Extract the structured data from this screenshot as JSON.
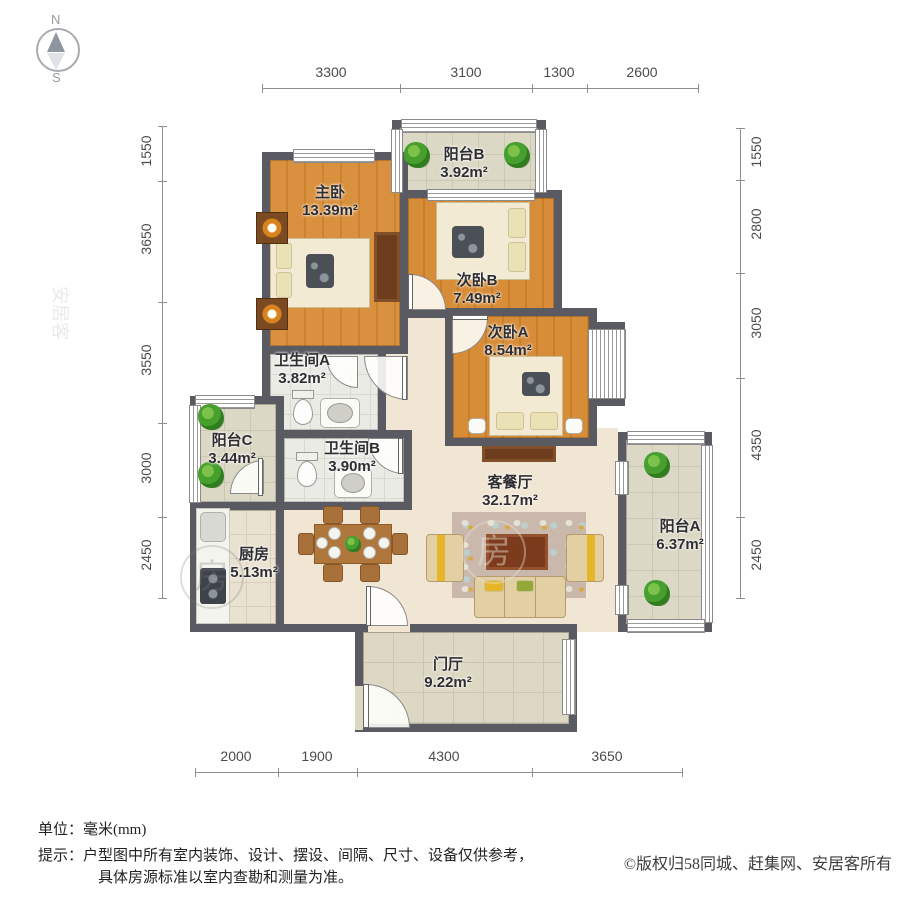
{
  "compass": {
    "north": "N",
    "south": "S"
  },
  "dims": {
    "top": [
      "3300",
      "3100",
      "1300",
      "2600"
    ],
    "bottom": [
      "2000",
      "1900",
      "4300",
      "3650"
    ],
    "left": [
      "1550",
      "3650",
      "3550",
      "3000",
      "2450"
    ],
    "right": [
      "1550",
      "2800",
      "3050",
      "4350",
      "2450"
    ]
  },
  "rooms": {
    "master": {
      "name": "主卧",
      "area": "13.39m²"
    },
    "balcony_b": {
      "name": "阳台B",
      "area": "3.92m²"
    },
    "bedroom_b": {
      "name": "次卧B",
      "area": "7.49m²"
    },
    "bedroom_a": {
      "name": "次卧A",
      "area": "8.54m²"
    },
    "bath_a": {
      "name": "卫生间A",
      "area": "3.82m²"
    },
    "balcony_c": {
      "name": "阳台C",
      "area": "3.44m²"
    },
    "bath_b": {
      "name": "卫生间B",
      "area": "3.90m²"
    },
    "kitchen": {
      "name": "厨房",
      "area": "5.13m²"
    },
    "living": {
      "name": "客餐厅",
      "area": "32.17m²"
    },
    "balcony_a": {
      "name": "阳台A",
      "area": "6.37m²"
    },
    "foyer": {
      "name": "门厅",
      "area": "9.22m²"
    }
  },
  "watermark": {
    "char": "房"
  },
  "footer": {
    "unit_label": "单位：毫米(mm)",
    "tip_line1": "提示：户型图中所有室内装饰、设计、摆设、间隔、尺寸、设备仅供参考，",
    "tip_line2": "具体房源标准以室内查勘和测量为准。",
    "copyright": "©版权归58同城、赶集网、安居客所有"
  },
  "colors": {
    "wall": "#5a5a62",
    "wood": "#d9913f",
    "living_floor": "#f1e5d3",
    "tile": "#dcd8c6"
  }
}
